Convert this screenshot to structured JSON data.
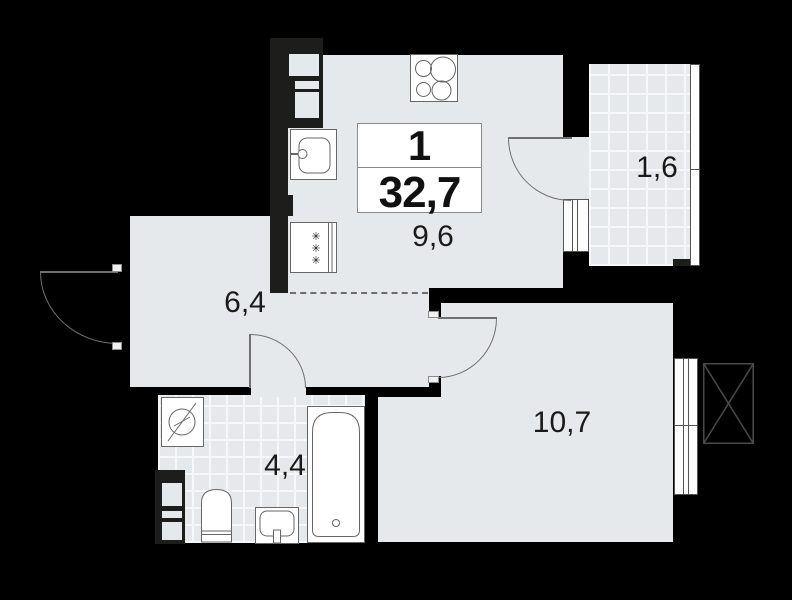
{
  "plan": {
    "type": "apartment-floor-plan",
    "unit": {
      "rooms_count": "1",
      "total_area": "32,7"
    },
    "rooms": {
      "kitchen": {
        "name": "kitchen",
        "area": "9,6"
      },
      "hallway": {
        "name": "hallway",
        "area": "6,4"
      },
      "balcony": {
        "name": "balcony",
        "area": "1,6"
      },
      "bathroom": {
        "name": "bathroom",
        "area": "4,4"
      },
      "living": {
        "name": "living-room",
        "area": "10,7"
      }
    },
    "icons": {
      "fridge_glyph": "✳",
      "stove": "four-burner-cooktop",
      "kitchen_sink": "kitchen-sink-with-faucet",
      "fridge": "refrigerator",
      "washing_machine": "washing-machine",
      "toilet": "toilet",
      "washbasin": "washbasin",
      "bathtub": "bathtub",
      "ac_unit": "crossed-box-ac-unit",
      "doors": "quarter-circle-swing-arcs",
      "windows": "double-line-window-symbols"
    },
    "colors": {
      "background": "#000000",
      "wall": "#1d1d1b",
      "floor": "#e6e9eb",
      "tile_line": "#f5f7f8",
      "fixture_outline": "#666664",
      "door_line": "#707070",
      "text": "#1a1a18"
    }
  }
}
